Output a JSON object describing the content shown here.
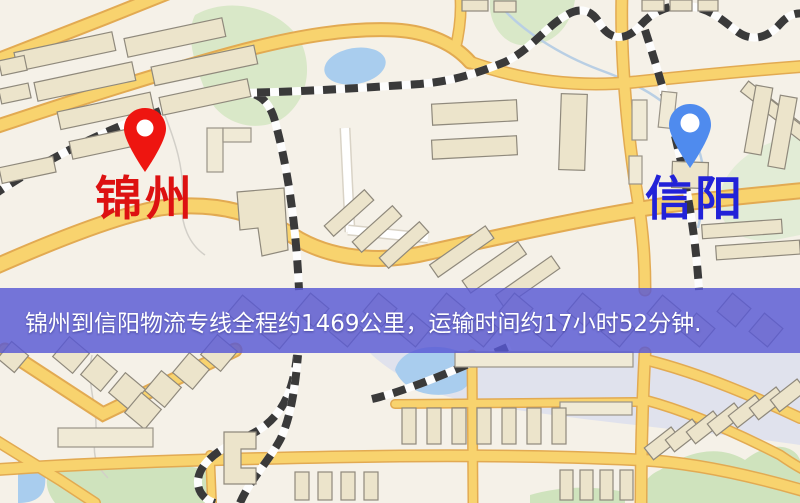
{
  "window": {
    "width": 800,
    "height": 503
  },
  "map": {
    "kind": "street-map",
    "markers": [
      {
        "id": "origin",
        "label": "锦州",
        "pin_color": "#ee1510",
        "label_color": "#dd1111",
        "pin_icon": "map-pin"
      },
      {
        "id": "destination",
        "label": "信阳",
        "pin_color": "#4f8bee",
        "label_color": "#2222d8",
        "pin_icon": "map-pin"
      }
    ],
    "banner": {
      "text": "锦州到信阳物流专线全程约1469公里，运输时间约17小时52分钟.",
      "bg_color": "#5858d4",
      "text_color": "#ffffff"
    },
    "route_info": {
      "origin": "锦州",
      "destination": "信阳",
      "distance": "约1469公里",
      "duration": "约17小时52分钟"
    }
  },
  "theme": {
    "map_bg": "#f5f1e8",
    "road_major": "#f8d36e",
    "road_casing": "#e2aa52",
    "water": "#a9cdee",
    "park": "#d9e8c8",
    "building": "#ece4cb",
    "railway": "#3a3a3a",
    "banner_text": "#ffffff"
  }
}
